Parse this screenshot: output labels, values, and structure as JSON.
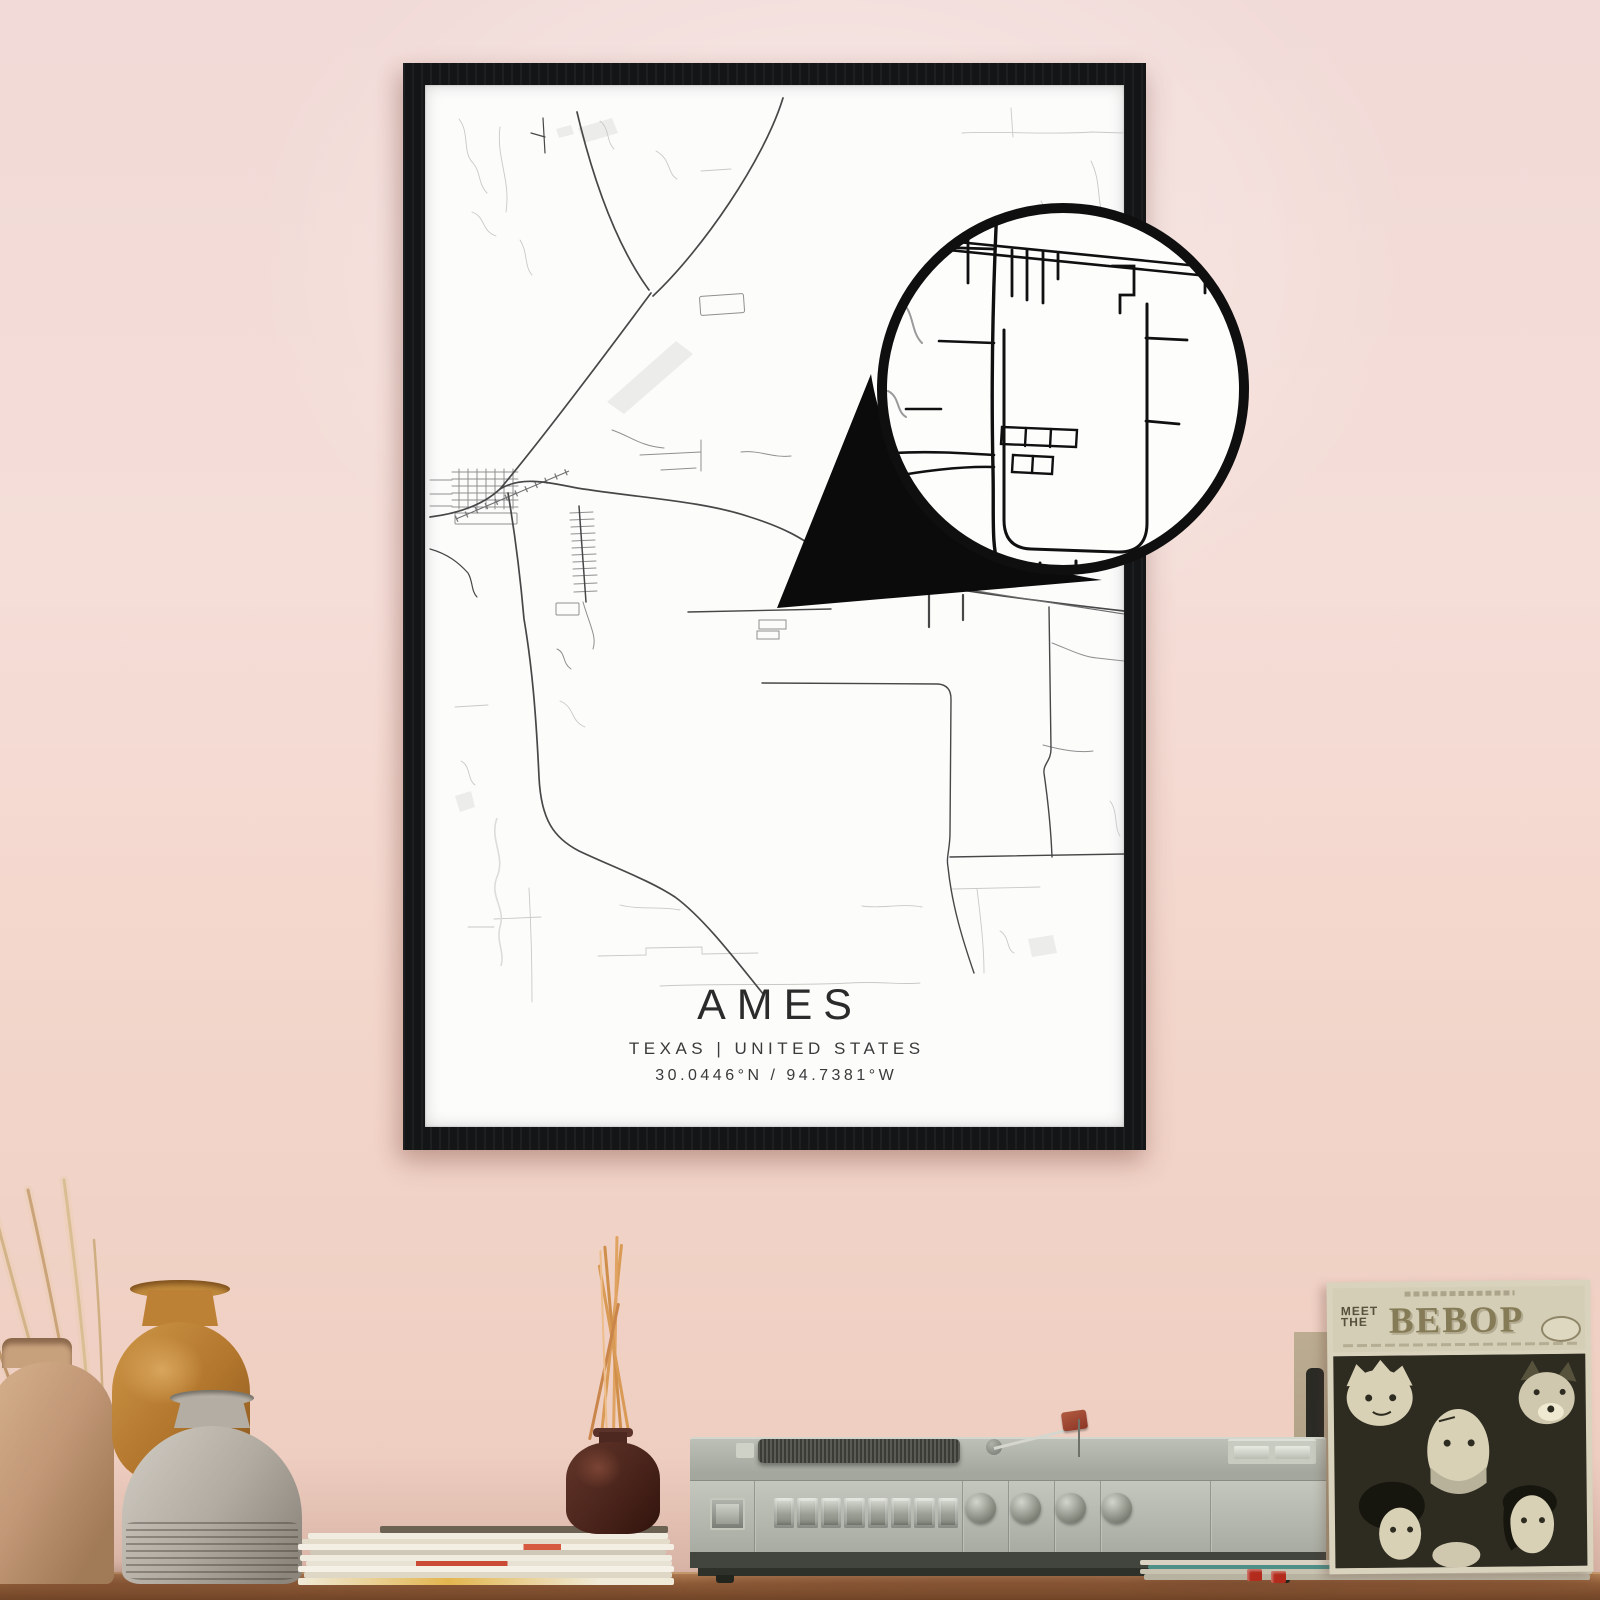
{
  "poster": {
    "title": "AMES",
    "subtitle": "TEXAS | UNITED STATES",
    "coordinates": "30.0446°N / 94.7381°W"
  },
  "album": {
    "meet_line1": "MEET",
    "meet_line2": "THE",
    "title": "BEBOP"
  },
  "colors": {
    "wall_top": "#f1dad7",
    "wall_bottom": "#edccbe",
    "frame": "#141516",
    "poster_bg": "#fcfcfb",
    "road_dark": "#474747",
    "road_faint": "#c6c6c6",
    "loupe_road": "#101010",
    "shelf_wood": "#8f5c38",
    "player_body": "#b3b7ae",
    "album_cream": "#d9d3bd",
    "album_dark": "#2e2c21",
    "reed": "#d9964f",
    "accent_red": "#b22b1c"
  }
}
